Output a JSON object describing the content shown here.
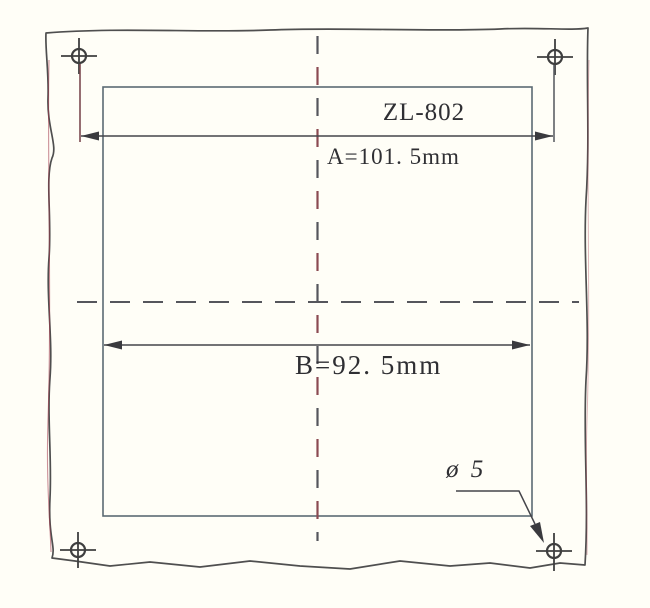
{
  "drawing": {
    "model_label": "ZL-802",
    "dimension_a_label": "A=101. 5mm",
    "dimension_b_label": "B=92. 5mm",
    "hole_diameter_label": "ø 5",
    "hole_count": 4,
    "colors": {
      "background": "#FFFEF7",
      "panel_edge_line": "#4F4F4F",
      "panel_edge_red_fringe": "#A3374A",
      "cutout_line": "#5C6A73",
      "centerline_gray": "#55565C",
      "centerline_red": "#8B4A52",
      "dimension_line": "#45454A",
      "arrow_fill": "#3A3A3E",
      "text": "#2F2F33"
    }
  }
}
